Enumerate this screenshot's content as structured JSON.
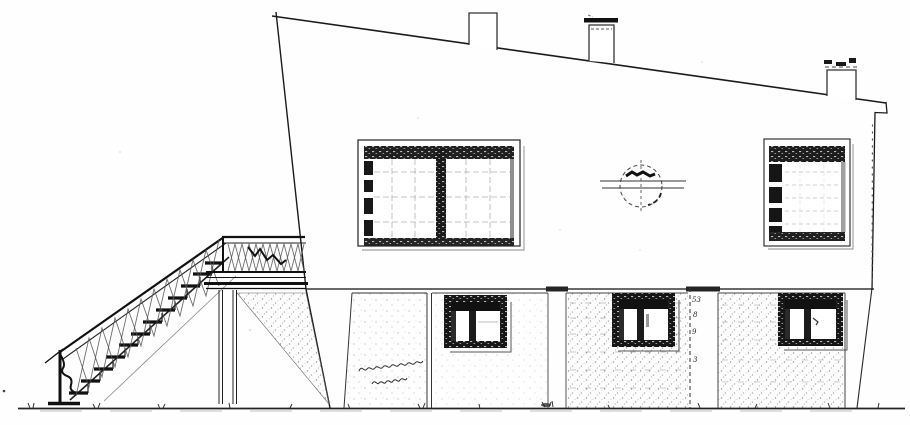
{
  "document": {
    "kind": "scanned architectural drawing",
    "view": "side elevation, two-storey house with external staircase"
  },
  "palette": {
    "paper": "#fefefe",
    "ink": "#1b1b1b",
    "ink_light": "#777777"
  },
  "annotations": {
    "dimension_figures": [
      "53",
      "8",
      "9",
      "3"
    ],
    "handwritten_note_lines": 2,
    "handwritten_note_legible": false
  },
  "features": {
    "chimneys": 3,
    "upper_windows": 2,
    "lower_windows": 3,
    "circular_wall_detail": 1,
    "stair_flights": 1
  }
}
